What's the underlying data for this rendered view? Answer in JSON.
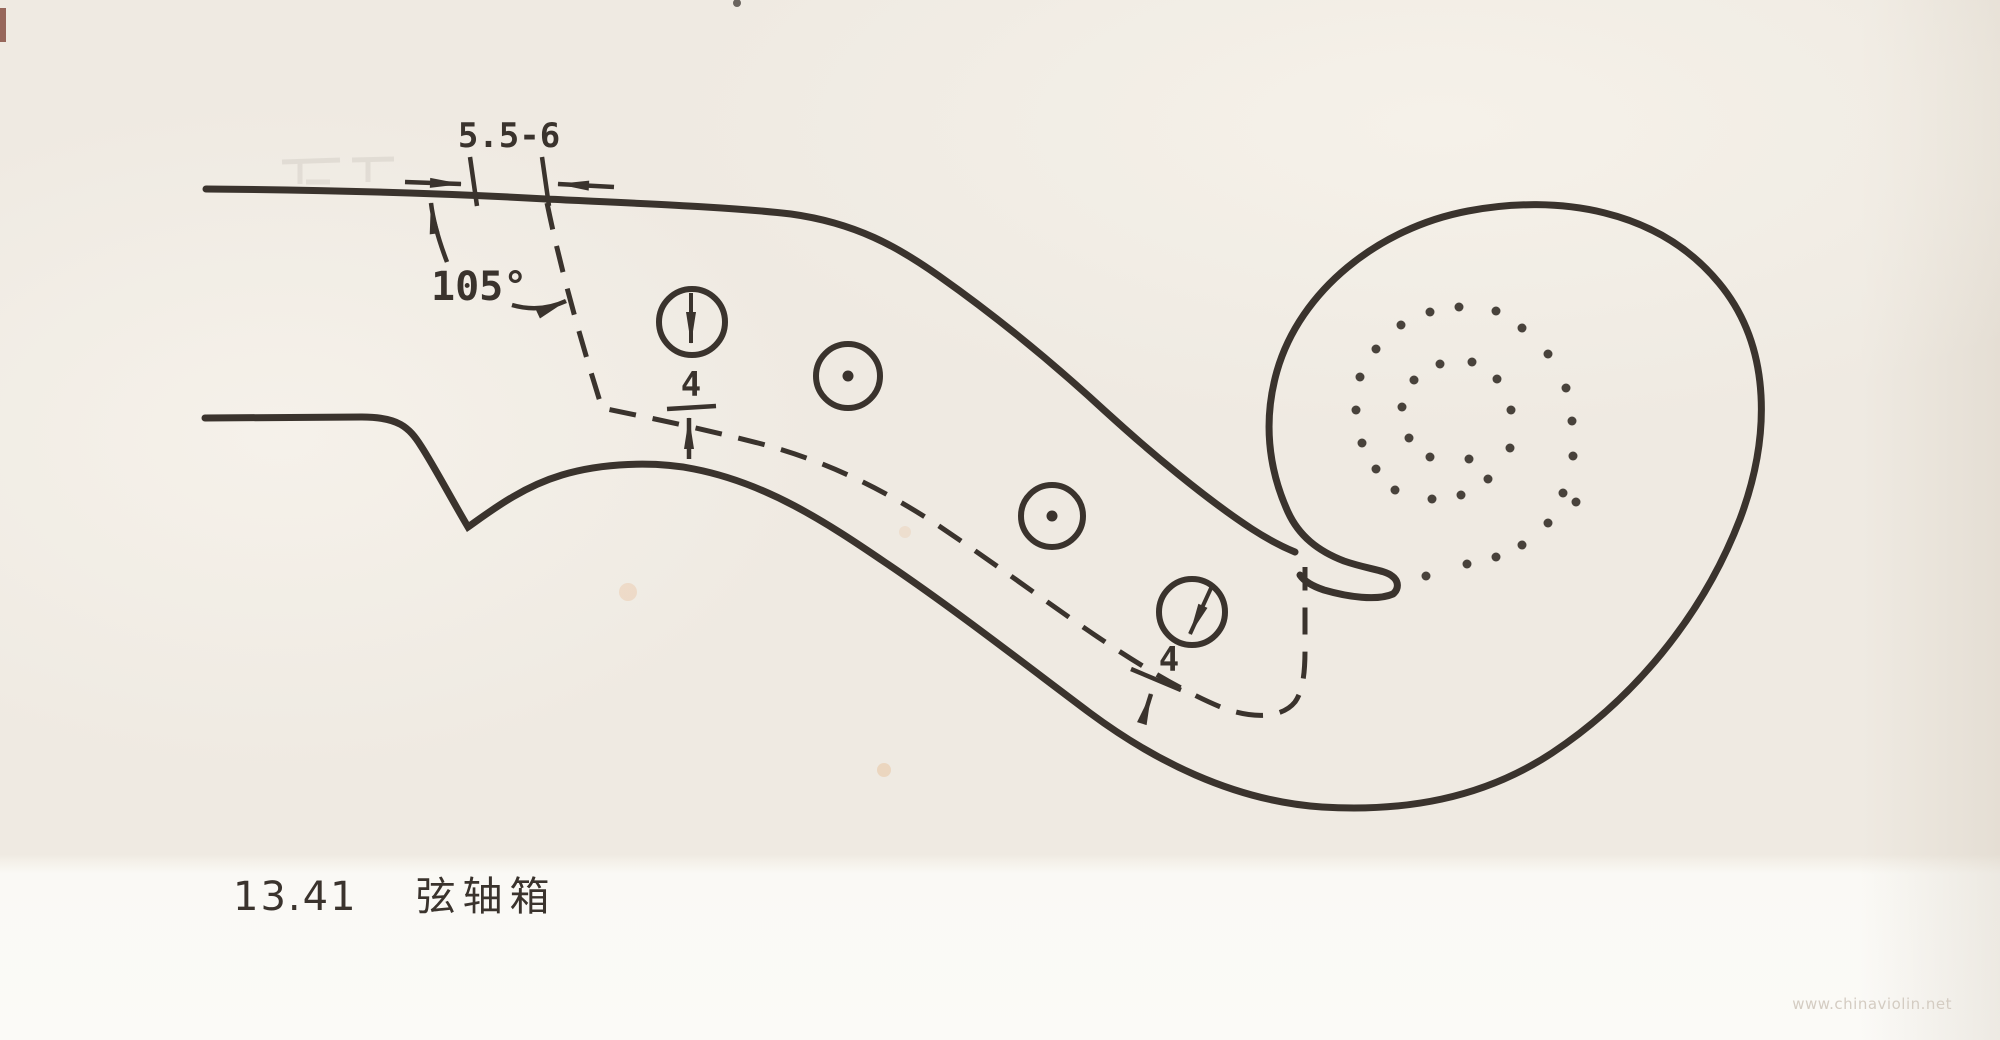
{
  "figure": {
    "caption_number": "13.41",
    "caption_title": "弦轴箱"
  },
  "annotations": {
    "nut_width": {
      "label": "5.5-6"
    },
    "pegbox_wall_angle": {
      "label": "105°"
    },
    "hole_edge_distance_upper": {
      "label": "4"
    },
    "hole_edge_distance_lower": {
      "label": "4"
    }
  },
  "watermark": {
    "text": "www.chinaviolin.net"
  },
  "colors": {
    "ink": "#3a332d",
    "paper": "#efeae2",
    "bottom_strip": "#fbfaf7",
    "watermark": "#d4ccc2"
  },
  "pegbox": {
    "holes": [
      {
        "cx": 692,
        "cy": 322,
        "r": 33,
        "axis_arrow": {
          "x1": 691,
          "y1": 293,
          "x2": 691,
          "y2": 343
        }
      },
      {
        "cx": 848,
        "cy": 376,
        "r": 32,
        "center_dot": true
      },
      {
        "cx": 1052,
        "cy": 516,
        "r": 31,
        "center_dot": true
      },
      {
        "cx": 1192,
        "cy": 612,
        "r": 33,
        "axis_arrow": {
          "x1": 1212,
          "y1": 586,
          "x2": 1190,
          "y2": 634
        }
      }
    ]
  },
  "scroll": {
    "stipple_dots": [
      [
        1430,
        312
      ],
      [
        1459,
        307
      ],
      [
        1496,
        311
      ],
      [
        1401,
        325
      ],
      [
        1522,
        328
      ],
      [
        1376,
        349
      ],
      [
        1440,
        364
      ],
      [
        1472,
        362
      ],
      [
        1548,
        354
      ],
      [
        1360,
        377
      ],
      [
        1414,
        380
      ],
      [
        1497,
        379
      ],
      [
        1566,
        388
      ],
      [
        1356,
        410
      ],
      [
        1402,
        407
      ],
      [
        1511,
        410
      ],
      [
        1572,
        421
      ],
      [
        1362,
        443
      ],
      [
        1409,
        438
      ],
      [
        1510,
        448
      ],
      [
        1430,
        457
      ],
      [
        1469,
        459
      ],
      [
        1573,
        456
      ],
      [
        1376,
        469
      ],
      [
        1488,
        479
      ],
      [
        1395,
        490
      ],
      [
        1432,
        499
      ],
      [
        1461,
        495
      ],
      [
        1563,
        493
      ],
      [
        1576,
        502
      ],
      [
        1548,
        523
      ],
      [
        1522,
        545
      ],
      [
        1496,
        557
      ],
      [
        1467,
        564
      ],
      [
        1426,
        576
      ]
    ]
  }
}
